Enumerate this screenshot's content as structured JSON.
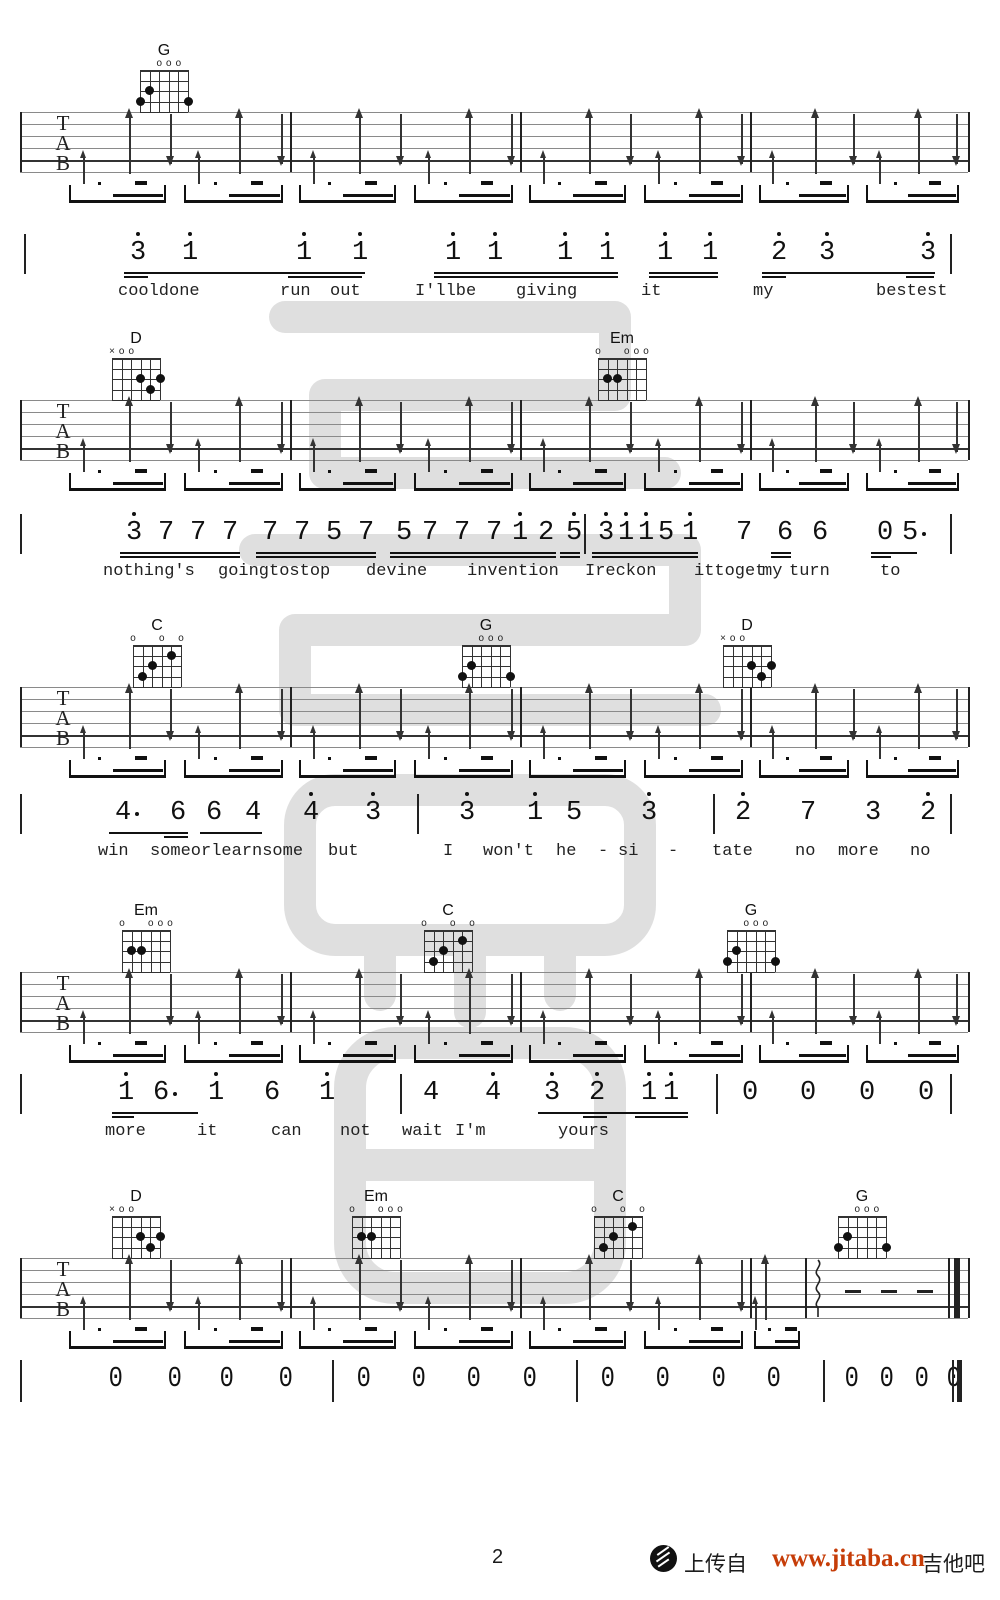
{
  "footer": {
    "page_number": "2",
    "upload_text": "上传自",
    "site_url": "www.jitaba.cn",
    "site_name": "吉他吧",
    "url_color": "#c63d08"
  },
  "watermark": {
    "name": "jitaba-watermark",
    "color": "#cbcbcb"
  },
  "tab_clef": [
    "T",
    "A",
    "B"
  ],
  "chord_shapes": {
    "G": {
      "markers": [
        "",
        "",
        "o",
        "o",
        "o",
        ""
      ],
      "dots": [
        [
          0,
          3
        ],
        [
          1,
          2
        ],
        [
          5,
          3
        ]
      ]
    },
    "D": {
      "markers": [
        "x",
        "o",
        "o",
        "",
        "",
        ""
      ],
      "dots": [
        [
          3,
          2
        ],
        [
          5,
          2
        ],
        [
          4,
          3
        ]
      ]
    },
    "Em": {
      "markers": [
        "o",
        "",
        "",
        "o",
        "o",
        "o"
      ],
      "dots": [
        [
          1,
          2
        ],
        [
          2,
          2
        ]
      ]
    },
    "C": {
      "markers": [
        "o",
        "",
        "",
        "o",
        "",
        "o"
      ],
      "dots": [
        [
          4,
          1
        ],
        [
          2,
          2
        ],
        [
          1,
          3
        ]
      ]
    }
  },
  "strum_pattern": [
    {
      "t": "su",
      "f": 0.1
    },
    {
      "t": "tu",
      "f": 0.3
    },
    {
      "t": "td",
      "f": 0.48
    },
    {
      "t": "su",
      "f": 0.6
    },
    {
      "t": "tu",
      "f": 0.78
    },
    {
      "t": "td",
      "f": 0.96
    }
  ],
  "systems": [
    {
      "y": 112,
      "chords": [
        {
          "name": "G",
          "x": 140
        }
      ]
    },
    {
      "y": 400,
      "chords": [
        {
          "name": "D",
          "x": 112
        },
        {
          "name": "Em",
          "x": 598
        }
      ]
    },
    {
      "y": 687,
      "chords": [
        {
          "name": "C",
          "x": 133
        },
        {
          "name": "G",
          "x": 462
        },
        {
          "name": "D",
          "x": 723
        }
      ]
    },
    {
      "y": 972,
      "chords": [
        {
          "name": "Em",
          "x": 122
        },
        {
          "name": "C",
          "x": 424
        },
        {
          "name": "G",
          "x": 727
        }
      ]
    },
    {
      "y": 1258,
      "chords": [
        {
          "name": "D",
          "x": 112
        },
        {
          "name": "Em",
          "x": 352
        },
        {
          "name": "C",
          "x": 594
        },
        {
          "name": "G",
          "x": 838
        }
      ],
      "ending": true
    }
  ],
  "melody_rows": [
    {
      "y": 238,
      "lyrics_y": 282,
      "notes": [
        {
          "v": "3",
          "x": 130,
          "d": 1
        },
        {
          "v": "1",
          "x": 182,
          "d": 1
        },
        {
          "v": "1",
          "x": 296,
          "d": 1
        },
        {
          "v": "1",
          "x": 352,
          "d": 1
        },
        {
          "v": "1",
          "x": 445,
          "d": 1
        },
        {
          "v": "1",
          "x": 487,
          "d": 1
        },
        {
          "v": "1",
          "x": 557,
          "d": 1
        },
        {
          "v": "1",
          "x": 599,
          "d": 1
        },
        {
          "v": "1",
          "x": 657,
          "d": 1
        },
        {
          "v": "1",
          "x": 702,
          "d": 1
        },
        {
          "v": "2",
          "x": 771,
          "d": 1
        },
        {
          "v": "3",
          "x": 819,
          "d": 1
        },
        {
          "v": "3",
          "x": 920,
          "d": 1
        }
      ],
      "beams": [
        {
          "a": 124,
          "b": 365,
          "n": 1
        },
        {
          "a": 124,
          "b": 148,
          "n": 2
        },
        {
          "a": 288,
          "b": 362,
          "n": 2
        },
        {
          "a": 434,
          "b": 618,
          "n": 2
        },
        {
          "a": 649,
          "b": 718,
          "n": 2
        },
        {
          "a": 762,
          "b": 935,
          "n": 1
        },
        {
          "a": 762,
          "b": 786,
          "n": 2
        },
        {
          "a": 906,
          "b": 934,
          "n": 2
        }
      ],
      "bars": [
        24,
        950
      ],
      "lyrics": [
        {
          "t": "cooldone",
          "x": 118
        },
        {
          "t": "run",
          "x": 280
        },
        {
          "t": "out",
          "x": 330
        },
        {
          "t": "I'llbe",
          "x": 415
        },
        {
          "t": "giving",
          "x": 516
        },
        {
          "t": "it",
          "x": 641
        },
        {
          "t": "my",
          "x": 753
        },
        {
          "t": "bestest",
          "x": 876
        }
      ]
    },
    {
      "y": 518,
      "lyrics_y": 562,
      "notes": [
        {
          "v": "3",
          "x": 126,
          "d": 1
        },
        {
          "v": "7",
          "x": 158
        },
        {
          "v": "7",
          "x": 190
        },
        {
          "v": "7",
          "x": 222
        },
        {
          "v": "7",
          "x": 262
        },
        {
          "v": "7",
          "x": 294
        },
        {
          "v": "5",
          "x": 326
        },
        {
          "v": "7",
          "x": 358
        },
        {
          "v": "5",
          "x": 396
        },
        {
          "v": "7",
          "x": 422
        },
        {
          "v": "7",
          "x": 454
        },
        {
          "v": "7",
          "x": 486
        },
        {
          "v": "1",
          "x": 512,
          "d": 1
        },
        {
          "v": "2",
          "x": 538
        },
        {
          "v": "5",
          "x": 566,
          "d": 1
        },
        {
          "v": "3",
          "x": 598,
          "d": 1
        },
        {
          "v": "1",
          "x": 618,
          "d": 1
        },
        {
          "v": "1",
          "x": 638,
          "d": 1
        },
        {
          "v": "5",
          "x": 658
        },
        {
          "v": "1",
          "x": 682,
          "d": 1
        },
        {
          "v": "7",
          "x": 736
        },
        {
          "v": "6",
          "x": 777
        },
        {
          "v": "6",
          "x": 812
        },
        {
          "v": "0",
          "x": 877
        },
        {
          "v": "5",
          "x": 902,
          "dd": 1
        }
      ],
      "beams": [
        {
          "a": 120,
          "b": 240,
          "n": 2
        },
        {
          "a": 256,
          "b": 376,
          "n": 2
        },
        {
          "a": 390,
          "b": 556,
          "n": 2
        },
        {
          "a": 560,
          "b": 580,
          "n": 2
        },
        {
          "a": 592,
          "b": 698,
          "n": 2
        },
        {
          "a": 771,
          "b": 791,
          "n": 2
        },
        {
          "a": 871,
          "b": 917,
          "n": 1
        },
        {
          "a": 871,
          "b": 891,
          "n": 2
        }
      ],
      "bars": [
        20,
        584,
        950
      ],
      "lyrics": [
        {
          "t": "nothing's",
          "x": 103
        },
        {
          "t": "goingtostop",
          "x": 218
        },
        {
          "t": "devine",
          "x": 366
        },
        {
          "t": "invention",
          "x": 467
        },
        {
          "t": "Ireckon",
          "x": 585
        },
        {
          "t": "ittoget",
          "x": 694
        },
        {
          "t": "my",
          "x": 762
        },
        {
          "t": "turn",
          "x": 789
        },
        {
          "t": "to",
          "x": 880
        }
      ]
    },
    {
      "y": 798,
      "lyrics_y": 842,
      "notes": [
        {
          "v": "4",
          "x": 115,
          "dd": 1
        },
        {
          "v": "6",
          "x": 170
        },
        {
          "v": "6",
          "x": 206
        },
        {
          "v": "4",
          "x": 245
        },
        {
          "v": "4",
          "x": 303,
          "d": 1
        },
        {
          "v": "3",
          "x": 365,
          "d": 1
        },
        {
          "v": "3",
          "x": 459,
          "d": 1
        },
        {
          "v": "1",
          "x": 527,
          "d": 1
        },
        {
          "v": "5",
          "x": 566
        },
        {
          "v": "3",
          "x": 641,
          "d": 1
        },
        {
          "v": "2",
          "x": 735,
          "d": 1
        },
        {
          "v": "7",
          "x": 800
        },
        {
          "v": "3",
          "x": 865
        },
        {
          "v": "2",
          "x": 920,
          "d": 1
        }
      ],
      "beams": [
        {
          "a": 109,
          "b": 188,
          "n": 1
        },
        {
          "a": 164,
          "b": 188,
          "n": 2
        },
        {
          "a": 200,
          "b": 262,
          "n": 1
        }
      ],
      "bars": [
        20,
        417,
        713,
        950
      ],
      "lyrics": [
        {
          "t": "win",
          "x": 98
        },
        {
          "t": "someorlearnsome",
          "x": 150
        },
        {
          "t": "but",
          "x": 328
        },
        {
          "t": "I",
          "x": 443
        },
        {
          "t": "won't",
          "x": 483
        },
        {
          "t": "he",
          "x": 556
        },
        {
          "t": "-",
          "x": 598
        },
        {
          "t": "si",
          "x": 618
        },
        {
          "t": "-",
          "x": 668
        },
        {
          "t": "tate",
          "x": 712
        },
        {
          "t": "no",
          "x": 795
        },
        {
          "t": "more",
          "x": 838
        },
        {
          "t": "no",
          "x": 910
        }
      ]
    },
    {
      "y": 1078,
      "lyrics_y": 1122,
      "notes": [
        {
          "v": "1",
          "x": 118,
          "d": 1
        },
        {
          "v": "6",
          "x": 153,
          "dd": 1
        },
        {
          "v": "1",
          "x": 208,
          "d": 1
        },
        {
          "v": "6",
          "x": 264
        },
        {
          "v": "1",
          "x": 319,
          "d": 1
        },
        {
          "v": "4",
          "x": 423
        },
        {
          "v": "4",
          "x": 485,
          "d": 1
        },
        {
          "v": "3",
          "x": 544,
          "d": 1
        },
        {
          "v": "2",
          "x": 589,
          "d": 1
        },
        {
          "v": "1",
          "x": 641,
          "d": 1
        },
        {
          "v": "1",
          "x": 663,
          "d": 1
        },
        {
          "v": "0",
          "x": 742
        },
        {
          "v": "0",
          "x": 800
        },
        {
          "v": "0",
          "x": 859
        },
        {
          "v": "0",
          "x": 918
        }
      ],
      "beams": [
        {
          "a": 112,
          "b": 198,
          "n": 1
        },
        {
          "a": 112,
          "b": 134,
          "n": 2
        },
        {
          "a": 538,
          "b": 688,
          "n": 1
        },
        {
          "a": 583,
          "b": 607,
          "n": 2
        },
        {
          "a": 635,
          "b": 688,
          "n": 2
        }
      ],
      "bars": [
        20,
        400,
        716,
        950
      ],
      "lyrics": [
        {
          "t": "more",
          "x": 105
        },
        {
          "t": "it",
          "x": 197
        },
        {
          "t": "can",
          "x": 271
        },
        {
          "t": "not",
          "x": 340
        },
        {
          "t": "wait",
          "x": 402
        },
        {
          "t": "I'm",
          "x": 455
        },
        {
          "t": "yours",
          "x": 558
        }
      ]
    }
  ],
  "zeros_row": {
    "y": 1362,
    "notes": [
      "0",
      "0",
      "0",
      "0",
      "0",
      "0",
      "0",
      "0",
      "0",
      "0",
      "0",
      "0",
      "0",
      "0",
      "0",
      "0"
    ],
    "xs": [
      107,
      166,
      218,
      277,
      355,
      410,
      465,
      521,
      599,
      654,
      710,
      765,
      843,
      878,
      913,
      945
    ],
    "bars": [
      20,
      332,
      576,
      823
    ],
    "final_bar": true
  }
}
